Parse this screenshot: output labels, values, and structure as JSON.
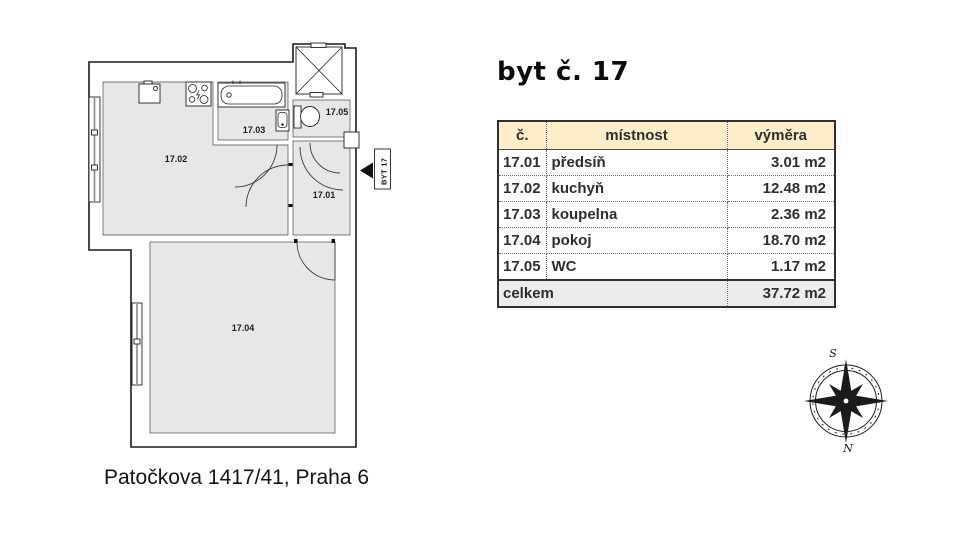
{
  "title": "byt č. 17",
  "address": "Patočkova 1417/41, Praha 6",
  "floorplan": {
    "labels": {
      "r1701": "17.01",
      "r1702": "17.02",
      "r1703": "17.03",
      "r1704": "17.04",
      "r1705": "17.05"
    },
    "unit_tag": "BYT 17",
    "compass": {
      "south": "S",
      "north": "N"
    }
  },
  "table": {
    "headers": {
      "number": "č.",
      "room": "místnost",
      "area": "výměra"
    },
    "rows": [
      {
        "number": "17.01",
        "room": "předsíň",
        "area": "3.01 m2"
      },
      {
        "number": "17.02",
        "room": "kuchyň",
        "area": "12.48 m2"
      },
      {
        "number": "17.03",
        "room": "koupelna",
        "area": "2.36 m2"
      },
      {
        "number": "17.04",
        "room": "pokoj",
        "area": "18.70 m2"
      },
      {
        "number": "17.05",
        "room": "WC",
        "area": "1.17 m2"
      }
    ],
    "footer": {
      "label": "celkem",
      "area": "37.72 m2"
    }
  },
  "colors": {
    "room_fill": "#e7e7e7",
    "wall_line": "#1a1a1a",
    "table_header_bg": "#fdeec9",
    "table_footer_bg": "#ececec"
  }
}
